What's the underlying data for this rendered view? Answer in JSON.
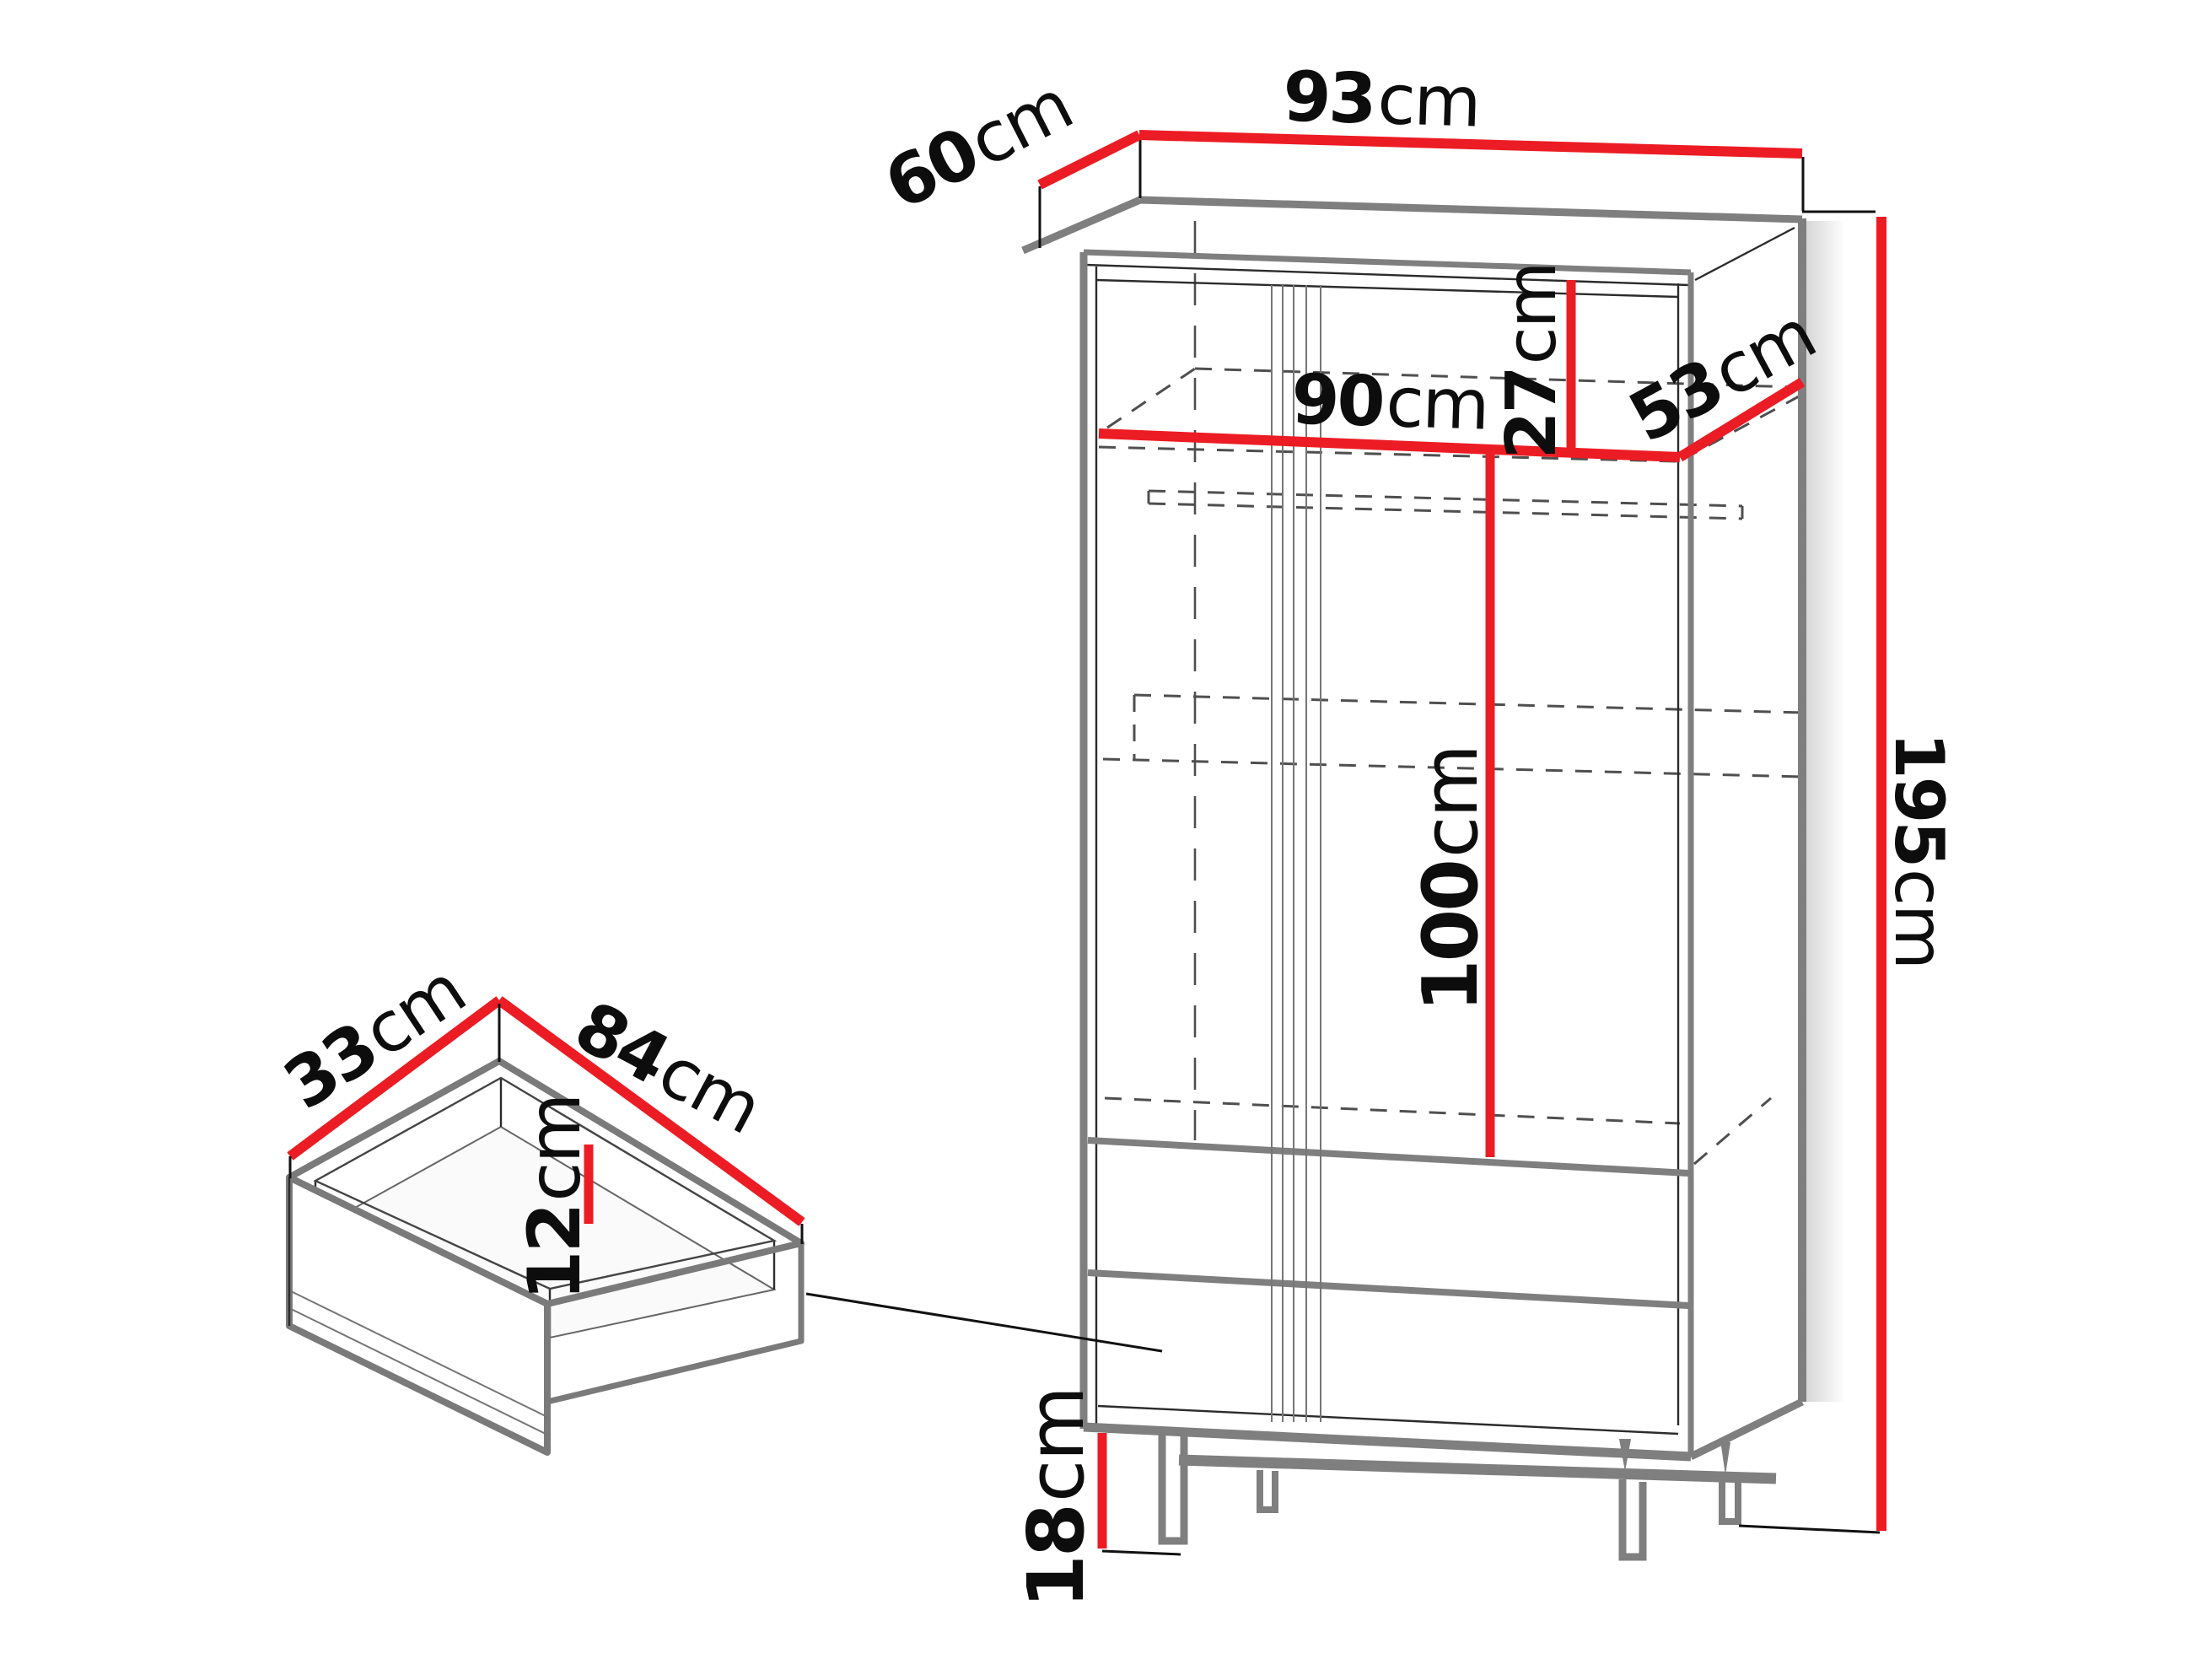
{
  "title": "Wardrobe dimensions diagram",
  "colors": {
    "dimension_line": "#ec1c24",
    "outline_thick": "#7f7f7f",
    "outline_thin": "#2b2b2b",
    "hidden_line": "#4f4f4f",
    "background": "#ffffff"
  },
  "dimensions": {
    "wardrobe": {
      "depth": {
        "value": "60",
        "unit": "cm"
      },
      "width": {
        "value": "93",
        "unit": "cm"
      },
      "interior_width": {
        "value": "90",
        "unit": "cm"
      },
      "top_compartment_height": {
        "value": "27",
        "unit": "cm"
      },
      "interior_depth": {
        "value": "53",
        "unit": "cm"
      },
      "hanging_space_height": {
        "value": "100",
        "unit": "cm"
      },
      "total_height": {
        "value": "195",
        "unit": "cm"
      },
      "legs_height": {
        "value": "18",
        "unit": "cm"
      }
    },
    "drawer": {
      "depth": {
        "value": "33",
        "unit": "cm"
      },
      "width": {
        "value": "84",
        "unit": "cm"
      },
      "interior_height": {
        "value": "12",
        "unit": "cm"
      }
    }
  }
}
